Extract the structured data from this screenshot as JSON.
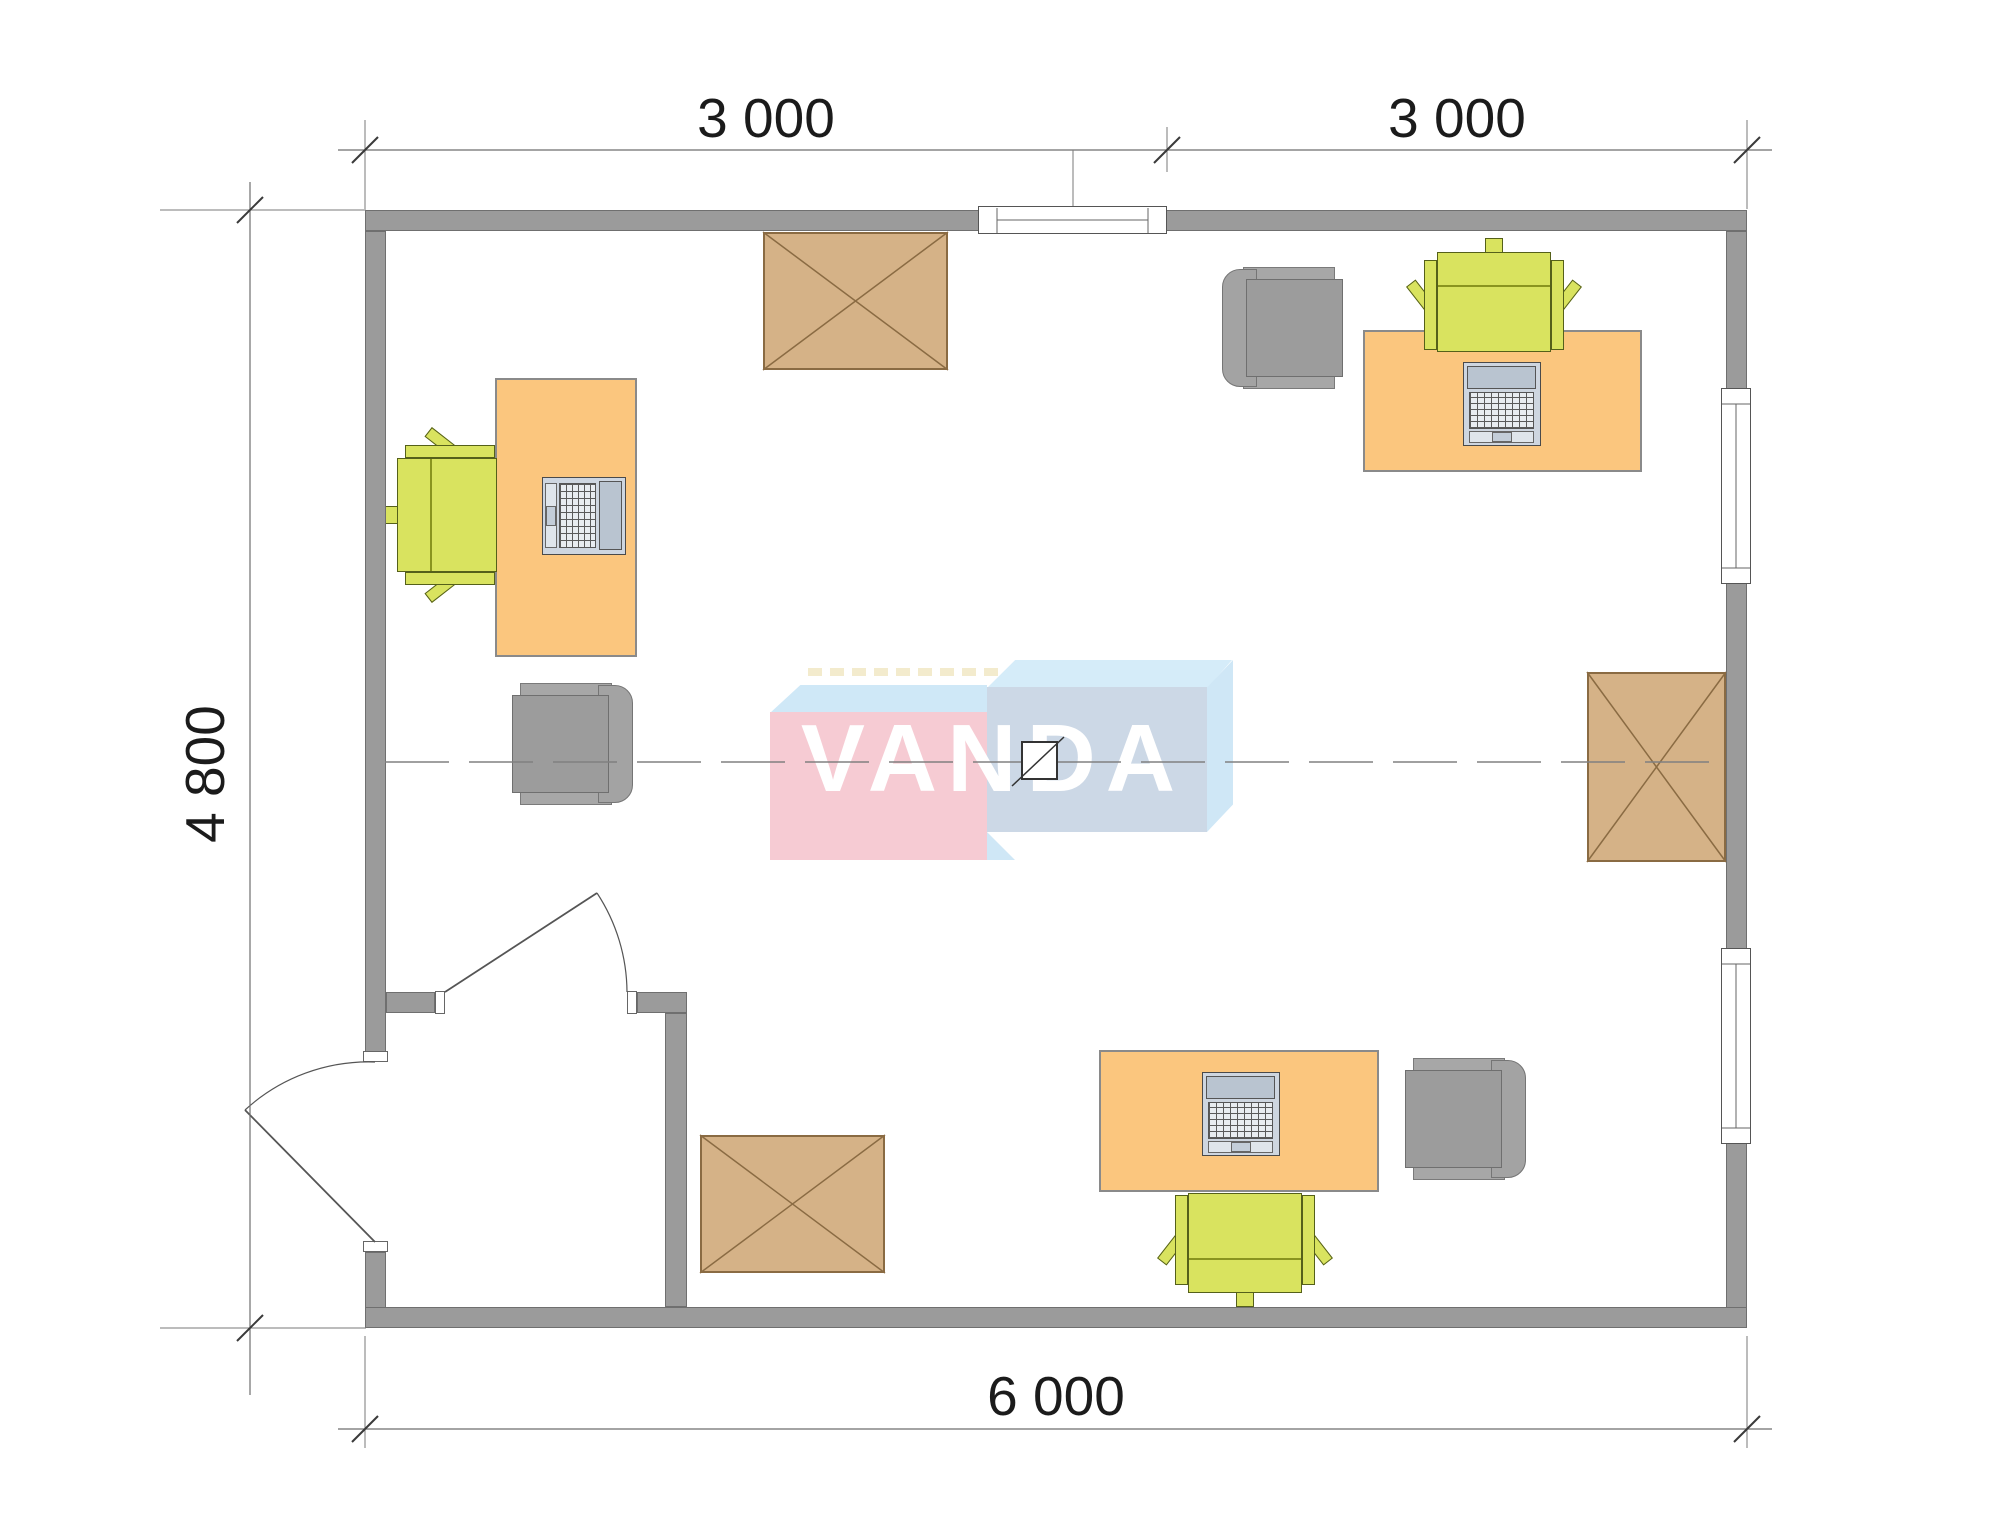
{
  "drawing": {
    "type": "office floor plan",
    "dimensions": {
      "top_left": "3 000",
      "top_right": "3 000",
      "side_left": "4 800",
      "bottom": "6 000"
    },
    "watermark": {
      "text": "VANDA"
    },
    "palette": {
      "wall": "#9b9b9b",
      "desk": "#fbc67e",
      "chair": "#d9e35f",
      "armchair": "#9c9c9c",
      "crate": "#d5b287",
      "logo_pink": "#f6cbd3",
      "logo_blue_light": "#d5ecf9",
      "logo_blue_gray": "#ccd8e6",
      "dimension_text": "#1b1b1b"
    },
    "furniture_inventory": [
      {
        "item": "desk with laptop",
        "count": 3
      },
      {
        "item": "office chair (green)",
        "count": 3
      },
      {
        "item": "armchair (gray)",
        "count": 3
      },
      {
        "item": "crossed storage box",
        "count": 3
      },
      {
        "item": "entrance door",
        "count": 2
      },
      {
        "item": "window",
        "count": 3
      }
    ]
  }
}
